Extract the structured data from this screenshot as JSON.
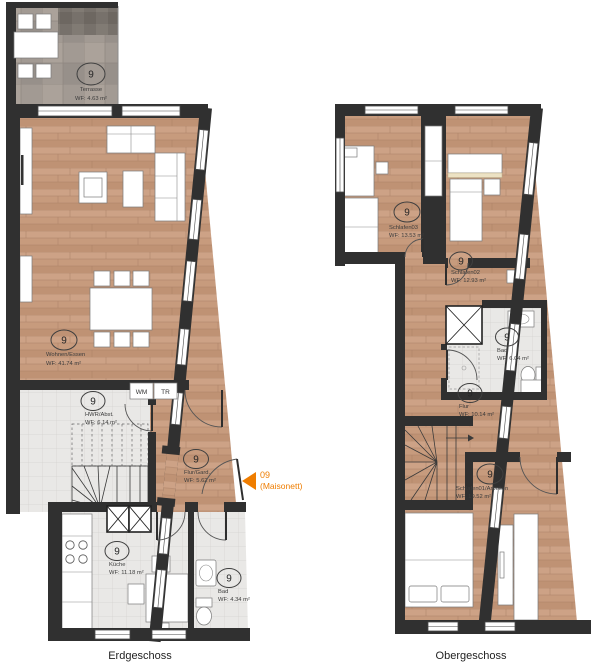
{
  "colors": {
    "accent_orange": "#ef7d00",
    "wall_dark": "#303030",
    "wood_floor": "#c79b7d",
    "tile_floor": "#e9e8e6",
    "terrace_tile": "#a29a93"
  },
  "unit_marker": {
    "number": "09",
    "label": "(Maisonett)"
  },
  "floors": [
    {
      "name": "Erdgeschoss",
      "appliances": {
        "washer": "WM",
        "dryer": "TR"
      },
      "rooms": [
        {
          "number": "9",
          "name": "Terrasse",
          "area": "WF: 4.63 m²"
        },
        {
          "number": "9",
          "name": "Wohnen/Essen",
          "area": "WF: 41.74 m²"
        },
        {
          "number": "9",
          "name": "HWR/Abst.",
          "area": "WF: 6.14 m²"
        },
        {
          "number": "9",
          "name": "Flur/Gard.",
          "area": "WF: 5.62 m²"
        },
        {
          "number": "9",
          "name": "Küche",
          "area": "WF: 11.18 m²"
        },
        {
          "number": "9",
          "name": "Bad",
          "area": "WF: 4.34 m²"
        }
      ]
    },
    {
      "name": "Obergeschoss",
      "rooms": [
        {
          "number": "9",
          "name": "Schlafen03",
          "area": "WF: 13.53 m²"
        },
        {
          "number": "9",
          "name": "Schlafen02",
          "area": "WF: 12.93 m²"
        },
        {
          "number": "9",
          "name": "Bad",
          "area": "WF: 6.04 m²"
        },
        {
          "number": "9",
          "name": "Flur",
          "area": "WF: 10.14 m²"
        },
        {
          "number": "9",
          "name": "Schlafen01/Arbeiten",
          "area": "WF: 19.52 m²"
        }
      ]
    }
  ]
}
